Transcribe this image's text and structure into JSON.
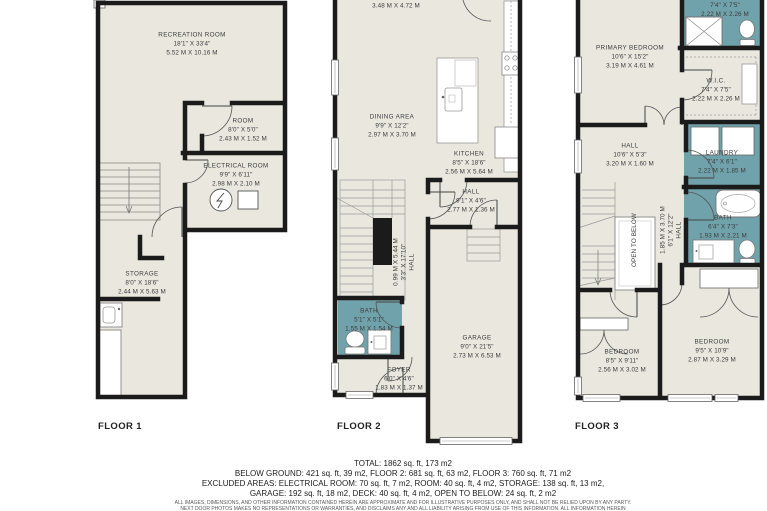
{
  "colors": {
    "floor_fill": "#e9e7de",
    "wall": "#1b1b1b",
    "wet_room_fill": "#6fa2aa",
    "label_text": "#3c3c3c"
  },
  "floor1": {
    "label": "FLOOR 1",
    "recreation": {
      "name": "RECREATION ROOM",
      "imperial": "18'1\" X 33'4\"",
      "metric": "5.52 M X 10.16 M"
    },
    "room": {
      "name": "ROOM",
      "imperial": "8'0\" X 5'0\"",
      "metric": "2.43 M X 1.52 M"
    },
    "electrical": {
      "name": "ELECTRICAL ROOM",
      "imperial": "9'9\" X 6'11\"",
      "metric": "2.98 M X 2.10 M"
    },
    "storage": {
      "name": "STORAGE",
      "imperial": "8'0\" X 18'6\"",
      "metric": "2.44 M X 5.63 M"
    }
  },
  "floor2": {
    "label": "FLOOR 2",
    "partial_metric": "3.48 M X 4.72 M",
    "dining": {
      "name": "DINING AREA",
      "imperial": "9'9\" X 12'2\"",
      "metric": "2.97 M X 3.70 M"
    },
    "kitchen": {
      "name": "KITCHEN",
      "imperial": "8'5\" X 18'6\"",
      "metric": "2.56 M X 5.64 M"
    },
    "hall": {
      "name": "HALL",
      "imperial": "9'1\" X 4'6\"",
      "metric": "2.77 M X 1.36 M"
    },
    "hall2": {
      "name": "HALL",
      "imperial": "3'3\" X 17'10\"",
      "metric": "0.99 M X 5.44 M"
    },
    "bath": {
      "name": "BATH",
      "imperial": "5'1\" X 5'1\"",
      "metric": "1.55 M X 1.54 M"
    },
    "foyer": {
      "name": "FOYER",
      "imperial": "6'0\" X 4'6\"",
      "metric": "1.83 M X 1.37 M"
    },
    "garage": {
      "name": "GARAGE",
      "imperial": "9'0\" X 21'5\"",
      "metric": "2.73 M X 6.53 M"
    }
  },
  "floor3": {
    "label": "FLOOR 3",
    "top_bath": {
      "imperial": "7'4\" X 7'5\"",
      "metric": "2.22 M X 2.26 M"
    },
    "primary": {
      "name": "PRIMARY BEDROOM",
      "imperial": "10'6\" X 15'2\"",
      "metric": "3.19 M X 4.61 M"
    },
    "wic": {
      "name": "W.I.C.",
      "imperial": "7'4\" X 7'5\"",
      "metric": "2.22 M X 2.26 M"
    },
    "hall": {
      "name": "HALL",
      "imperial": "10'6\" X 5'3\"",
      "metric": "3.20 M X 1.60 M"
    },
    "laundry": {
      "name": "LAUNDRY",
      "imperial": "7'4\" X 6'1\"",
      "metric": "2.22 M X 1.85 M"
    },
    "bath": {
      "name": "BATH",
      "imperial": "6'4\" X 7'3\"",
      "metric": "1.93 M X 2.21 M"
    },
    "open_to_below": "OPEN TO BELOW",
    "hall2": {
      "name": "HALL",
      "imperial": "6'1\" X 12'2\"",
      "metric": "1.85 M X 3.70 M"
    },
    "bedroom_left": {
      "name": "BEDROOM",
      "imperial": "8'5\" X 9'11\"",
      "metric": "2.56 M X 3.02 M"
    },
    "bedroom_right": {
      "name": "BEDROOM",
      "imperial": "9'5\" X 10'9\"",
      "metric": "2.87 M X 3.29 M"
    }
  },
  "summary": {
    "total": "TOTAL: 1862 sq. ft, 173 m2",
    "line2": "BELOW GROUND: 421 sq. ft, 39 m2, FLOOR 2: 681 sq. ft, 63 m2, FLOOR 3: 760 sq. ft, 71 m2",
    "line3": "EXCLUDED AREAS: ELECTRICAL ROOM: 70 sq. ft, 7 m2, ROOM: 40 sq. ft, 4 m2, STORAGE: 138 sq. ft, 13 m2,",
    "line4": "GARAGE: 192 sq. ft, 18 m2, DECK: 40 sq. ft, 4 m2, OPEN TO BELOW: 24 sq. ft, 2 m2"
  },
  "fineprint": {
    "line1": "ALL IMAGES, DIMENSIONS, AND OTHER INFORMATION CONTAINED HEREIN ARE APPROXIMATE AND FOR ILLUSTRATIVE PURPOSES ONLY, AND SHALL NOT BE RELIED UPON BY ANY PARTY.",
    "line2": "NEXT DOOR PHOTOS MAKES NO REPRESENTATIONS OR WARRANTIES, AND DISCLAIMS ANY AND ALL LIABILITY ARISING FROM USE OF THIS INFORMATION. ALL INFORMATION HEREIN"
  }
}
